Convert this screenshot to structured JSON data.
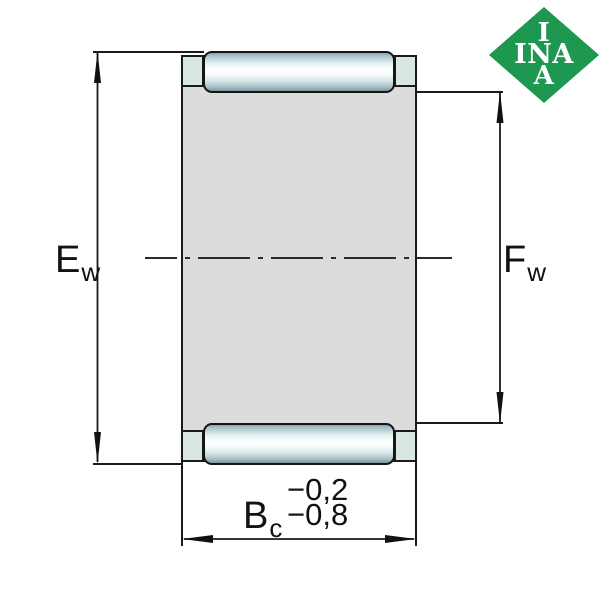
{
  "colors": {
    "background": "#ffffff",
    "outline": "#1a1a1a",
    "body-fill": "#dcdcdc",
    "tab-fill": "#d8e7e1",
    "roller-edge": "#7d97a0",
    "logo-green": "#1e9751",
    "logo-text": "#ffffff"
  },
  "labels": {
    "ew": {
      "base": "E",
      "sub": "w"
    },
    "fw": {
      "base": "F",
      "sub": "w"
    },
    "bc": {
      "base": "B",
      "sub": "c",
      "tolerance_upper": "−0,2",
      "tolerance_lower": "−0,8"
    }
  },
  "logo": {
    "line1": "I",
    "line2": "INA",
    "line3": "A"
  }
}
